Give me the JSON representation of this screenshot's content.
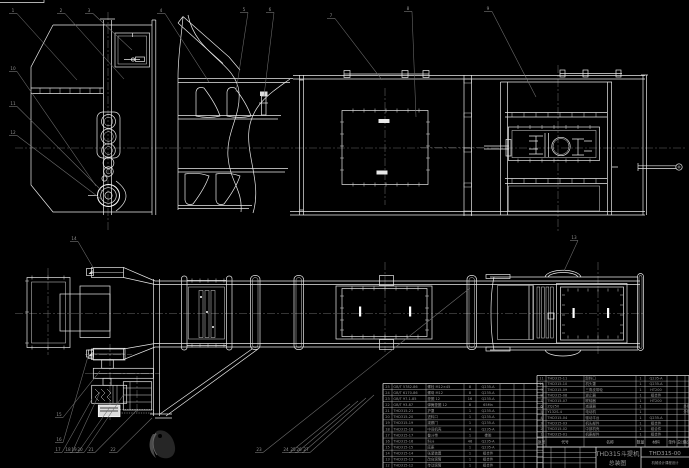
{
  "colors": {
    "background": "#000000",
    "line_white": "#e9e9e9",
    "leader_gray": "#707070",
    "centerline_gray": "#6a6a6a",
    "table_text": "#9a9a9a"
  },
  "title_block": {
    "product_name": "THD315斗提机",
    "drawing_type": "总装图",
    "drawing_number": "THD315-00",
    "organization": "机械设计课程设计"
  },
  "bom_header": [
    "序号",
    "代号",
    "名称",
    "数量",
    "材料",
    "单件",
    "总计",
    "备注"
  ],
  "bom_right": {
    "x": 537,
    "y": 375.5,
    "row_h": 5.6,
    "header_h": 9.9,
    "cols": [
      0,
      9,
      47,
      99,
      108,
      130,
      140,
      148,
      152
    ],
    "rows": [
      [
        "11",
        "THD315-11",
        "卸料口",
        "1",
        "Q235-A",
        "",
        "",
        ""
      ],
      [
        "10",
        "THD315-10",
        "机头罩",
        "1",
        "Q235-A",
        "",
        "",
        ""
      ],
      [
        "9",
        "THD315-09",
        "三角皮带轮",
        "1",
        "HT200",
        "",
        "",
        ""
      ],
      [
        "8",
        "THD315-08",
        "逆止器",
        "1",
        "组合件",
        "",
        "",
        ""
      ],
      [
        "7",
        "THD315-07",
        "联轴器",
        "1",
        "HT200",
        "",
        "",
        ""
      ],
      [
        "6",
        "ZQ250",
        "减速器",
        "1",
        "",
        "",
        "",
        "外购"
      ],
      [
        "5",
        "Y132S-4",
        "电动机",
        "1",
        "",
        "",
        "",
        "外购"
      ],
      [
        "4",
        "THD315-04",
        "驱动平台",
        "1",
        "Q235-A",
        "",
        "",
        ""
      ],
      [
        "3",
        "THD315-03",
        "机头部件",
        "1",
        "组合件",
        "",
        "",
        ""
      ],
      [
        "2",
        "THD315-02",
        "中部机壳",
        "1",
        "组合件",
        "",
        "",
        ""
      ],
      [
        "1",
        "THD315-01",
        "机座部件",
        "1",
        "组合件",
        "",
        "",
        ""
      ]
    ]
  },
  "bom_left": {
    "x": 383,
    "y": 383.5,
    "row_h": 6.06,
    "header_h": 0,
    "cols": [
      0,
      9,
      43,
      81,
      93,
      117,
      131,
      141,
      160
    ],
    "rows": [
      [
        "25",
        "GB/T 5782-86",
        "螺栓 M12×45",
        "8",
        "Q235-A",
        "",
        "",
        ""
      ],
      [
        "24",
        "GB/T 6170-86",
        "螺母 M12",
        "8",
        "Q235-A",
        "",
        "",
        ""
      ],
      [
        "23",
        "GB/T 97.1-85",
        "垫圈 12",
        "16",
        "Q235-A",
        "",
        "",
        ""
      ],
      [
        "22",
        "GB/T 93-87",
        "弹簧垫圈 12",
        "8",
        "65Mn",
        "",
        "",
        ""
      ],
      [
        "21",
        "THD315-21",
        "护罩",
        "1",
        "Q235-A",
        "",
        "",
        ""
      ],
      [
        "20",
        "THD315-20",
        "进料口",
        "1",
        "Q235-A",
        "",
        "",
        ""
      ],
      [
        "19",
        "THD315-19",
        "观察门",
        "1",
        "Q235-A",
        "",
        "",
        ""
      ],
      [
        "18",
        "THD315-18",
        "中间机壳",
        "4",
        "Q235-A",
        "",
        "",
        ""
      ],
      [
        "17",
        "THD315-17",
        "畚斗带",
        "1",
        "橡胶",
        "",
        "",
        ""
      ],
      [
        "16",
        "THD315-16",
        "料斗",
        "46",
        "Q235-A",
        "",
        "",
        ""
      ],
      [
        "15",
        "THD315-15",
        "底座",
        "1",
        "Q235-A",
        "",
        "",
        ""
      ],
      [
        "14",
        "THD315-14",
        "张紧装置",
        "1",
        "组合件",
        "",
        "",
        ""
      ],
      [
        "13",
        "THD315-13",
        "改向滚筒",
        "1",
        "组合件",
        "",
        "",
        ""
      ],
      [
        "12",
        "THD315-12",
        "传动滚筒",
        "1",
        "组合件",
        "",
        "",
        ""
      ]
    ]
  },
  "balloons": [
    {
      "n": "1",
      "x": 12,
      "y": 10,
      "tx": 77,
      "ty": 80
    },
    {
      "n": "2",
      "x": 60,
      "y": 10,
      "tx": 124,
      "ty": 79
    },
    {
      "n": "3",
      "x": 88,
      "y": 10,
      "tx": 132,
      "ty": 50
    },
    {
      "n": "4",
      "x": 160,
      "y": 10,
      "tx": 209,
      "ty": 82
    },
    {
      "n": "5",
      "x": 243,
      "y": 9,
      "tx": 236,
      "ty": 92
    },
    {
      "n": "6",
      "x": 269,
      "y": 9,
      "tx": 264,
      "ty": 96
    },
    {
      "n": "7",
      "x": 330,
      "y": 15,
      "tx": 382,
      "ty": 80
    },
    {
      "n": "8",
      "x": 407,
      "y": 8,
      "tx": 416,
      "ty": 117
    },
    {
      "n": "9",
      "x": 487,
      "y": 8,
      "tx": 536,
      "ty": 97
    },
    {
      "n": "10",
      "x": 12,
      "y": 68,
      "tx": 96,
      "ty": 186
    },
    {
      "n": "11",
      "x": 12,
      "y": 103,
      "tx": 104,
      "ty": 193
    },
    {
      "n": "12",
      "x": 12,
      "y": 132,
      "tx": 101,
      "ty": 199
    },
    {
      "n": "13",
      "x": 573,
      "y": 237,
      "tx": 564,
      "ty": 271
    },
    {
      "n": "14",
      "x": 73,
      "y": 238,
      "tx": 94,
      "ty": 269
    },
    {
      "n": "15",
      "x": 58,
      "y": 414,
      "tx": 100,
      "ty": 371
    },
    {
      "n": "16",
      "x": 58,
      "y": 439,
      "tx": 89,
      "ty": 353
    },
    {
      "n": "17",
      "x": 57,
      "y": 449,
      "tx": 92,
      "ty": 399
    },
    {
      "n": "18",
      "x": 67,
      "y": 449,
      "tx": 100,
      "ty": 392
    },
    {
      "n": "19",
      "x": 73,
      "y": 449,
      "tx": 110,
      "ty": 407
    },
    {
      "n": "20",
      "x": 79,
      "y": 449,
      "tx": 124,
      "ty": 394
    },
    {
      "n": "21",
      "x": 90,
      "y": 449,
      "tx": 136,
      "ty": 411
    },
    {
      "n": "22",
      "x": 112,
      "y": 449,
      "tx": 152,
      "ty": 418
    },
    {
      "n": "23",
      "x": 258,
      "y": 449,
      "tx": 470,
      "ty": 288
    },
    {
      "n": "24",
      "x": 285,
      "y": 449,
      "tx": 350,
      "ty": 404
    },
    {
      "n": "25",
      "x": 292,
      "y": 449,
      "tx": 358,
      "ty": 401
    },
    {
      "n": "26",
      "x": 298,
      "y": 449,
      "tx": 366,
      "ty": 398
    },
    {
      "n": "27",
      "x": 305,
      "y": 449,
      "tx": 374,
      "ty": 395
    }
  ]
}
